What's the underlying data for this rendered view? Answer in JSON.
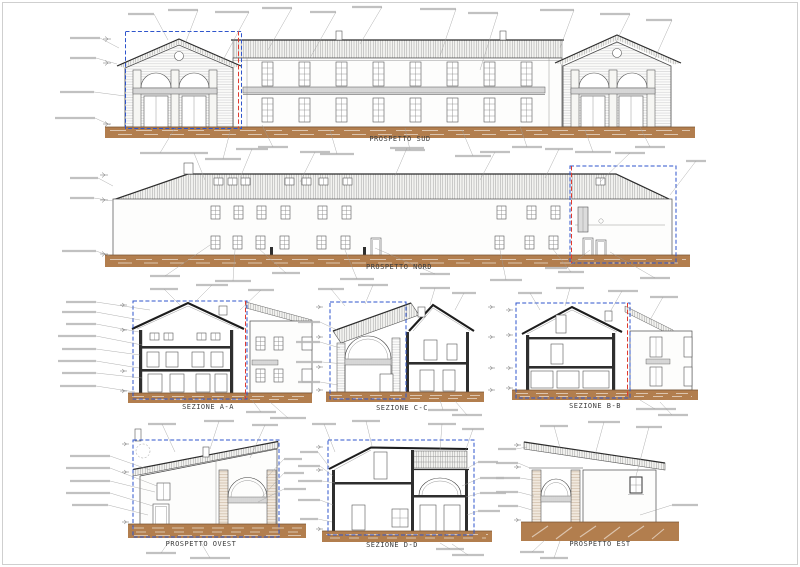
{
  "sheet": {
    "description": "Architectural drawing sheet with building elevations and sections",
    "drawings": [
      {
        "id": "prospetto-sud",
        "title": "PROSPETTO SUD",
        "type": "elevation"
      },
      {
        "id": "prospetto-nord",
        "title": "PROSPETTO NORD",
        "type": "elevation"
      },
      {
        "id": "sezione-a-a",
        "title": "SEZIONE A-A",
        "type": "section"
      },
      {
        "id": "sezione-c-c",
        "title": "SEZIONE C-C",
        "type": "section"
      },
      {
        "id": "sezione-b-b",
        "title": "SEZIONE B-B",
        "type": "section"
      },
      {
        "id": "prospetto-ovest",
        "title": "PROSPETTO OVEST",
        "type": "elevation"
      },
      {
        "id": "sezione-d-d",
        "title": "SEZIONE D-D",
        "type": "section"
      },
      {
        "id": "prospetto-est",
        "title": "PROSPETTO EST",
        "type": "elevation"
      }
    ],
    "colors": {
      "ink": "#3f3f3f",
      "ground_brown": "#b27e4e",
      "highlight_blue": "#2f55cc",
      "section_cut_red": "#e03a2f",
      "hatch_gray": "#909090",
      "paper": "#ffffff"
    },
    "note": "numerous micro annotation labels on leader lines are present but not legible at this resolution"
  }
}
